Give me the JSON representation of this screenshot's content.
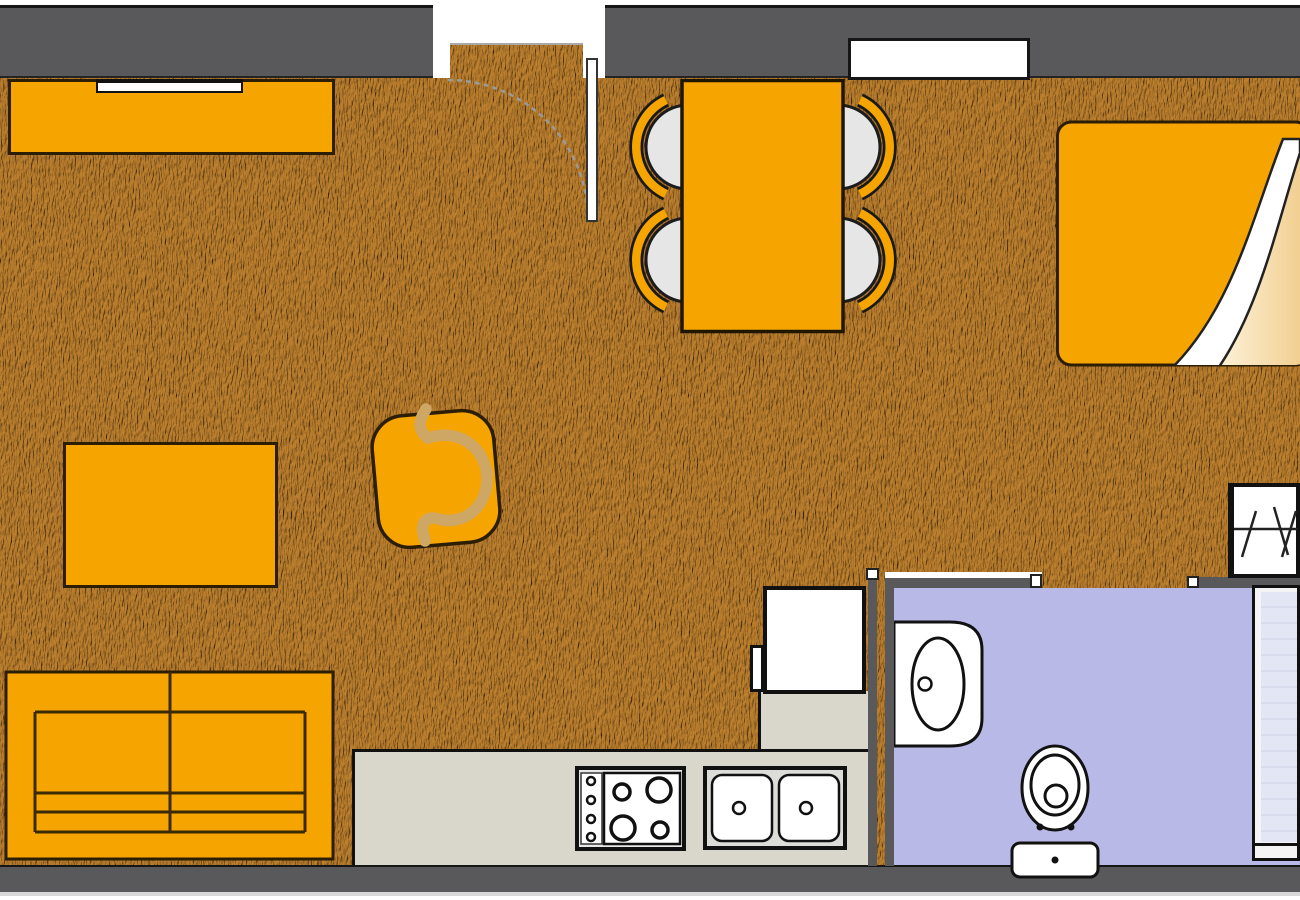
{
  "plan": {
    "type": "apartment floor plan, top-down view, no text labels",
    "rooms": [
      {
        "id": "living-dining-area",
        "floor_finish": "wood",
        "items": [
          {
            "id": "tv-sideboard",
            "count": 1
          },
          {
            "id": "tv",
            "count": 1
          },
          {
            "id": "entry-door",
            "count": 1
          },
          {
            "id": "coffee-table",
            "count": 1
          },
          {
            "id": "armchair",
            "count": 1
          },
          {
            "id": "sofa",
            "count": 1
          },
          {
            "id": "dining-table",
            "count": 1
          },
          {
            "id": "dining-chair",
            "count": 4
          },
          {
            "id": "double-bed",
            "count": 1
          },
          {
            "id": "window",
            "count": 1
          },
          {
            "id": "wardrobe",
            "count": 1
          }
        ]
      },
      {
        "id": "kitchen",
        "floor_finish": "wood",
        "items": [
          {
            "id": "l-shaped-counter",
            "count": 1
          },
          {
            "id": "refrigerator",
            "count": 1
          },
          {
            "id": "stove",
            "count": 1,
            "burners": 4
          },
          {
            "id": "kitchen-sink",
            "count": 1,
            "basins": 2
          }
        ]
      },
      {
        "id": "bathroom",
        "floor_finish": "lilac tile",
        "items": [
          {
            "id": "washbasin",
            "count": 1
          },
          {
            "id": "toilet",
            "count": 1
          },
          {
            "id": "shower",
            "count": 1
          }
        ]
      }
    ]
  },
  "colors": {
    "background_white": "#ffffff",
    "wall_gray": "#59595b",
    "line_black": "#161616",
    "floor_tan": "#d2a75f",
    "furniture_orange": "#f6a500",
    "outline_brown": "#2b1e04",
    "counter_gray": "#d9d6cc",
    "bathroom_lilac": "#b9b9e8",
    "shower_blue": "#e2e6f5",
    "chair_seat_gray": "#e6e6e6",
    "bed_linen_cream": "#f2cf92",
    "door_arc_gray": "#9a9a9a"
  }
}
